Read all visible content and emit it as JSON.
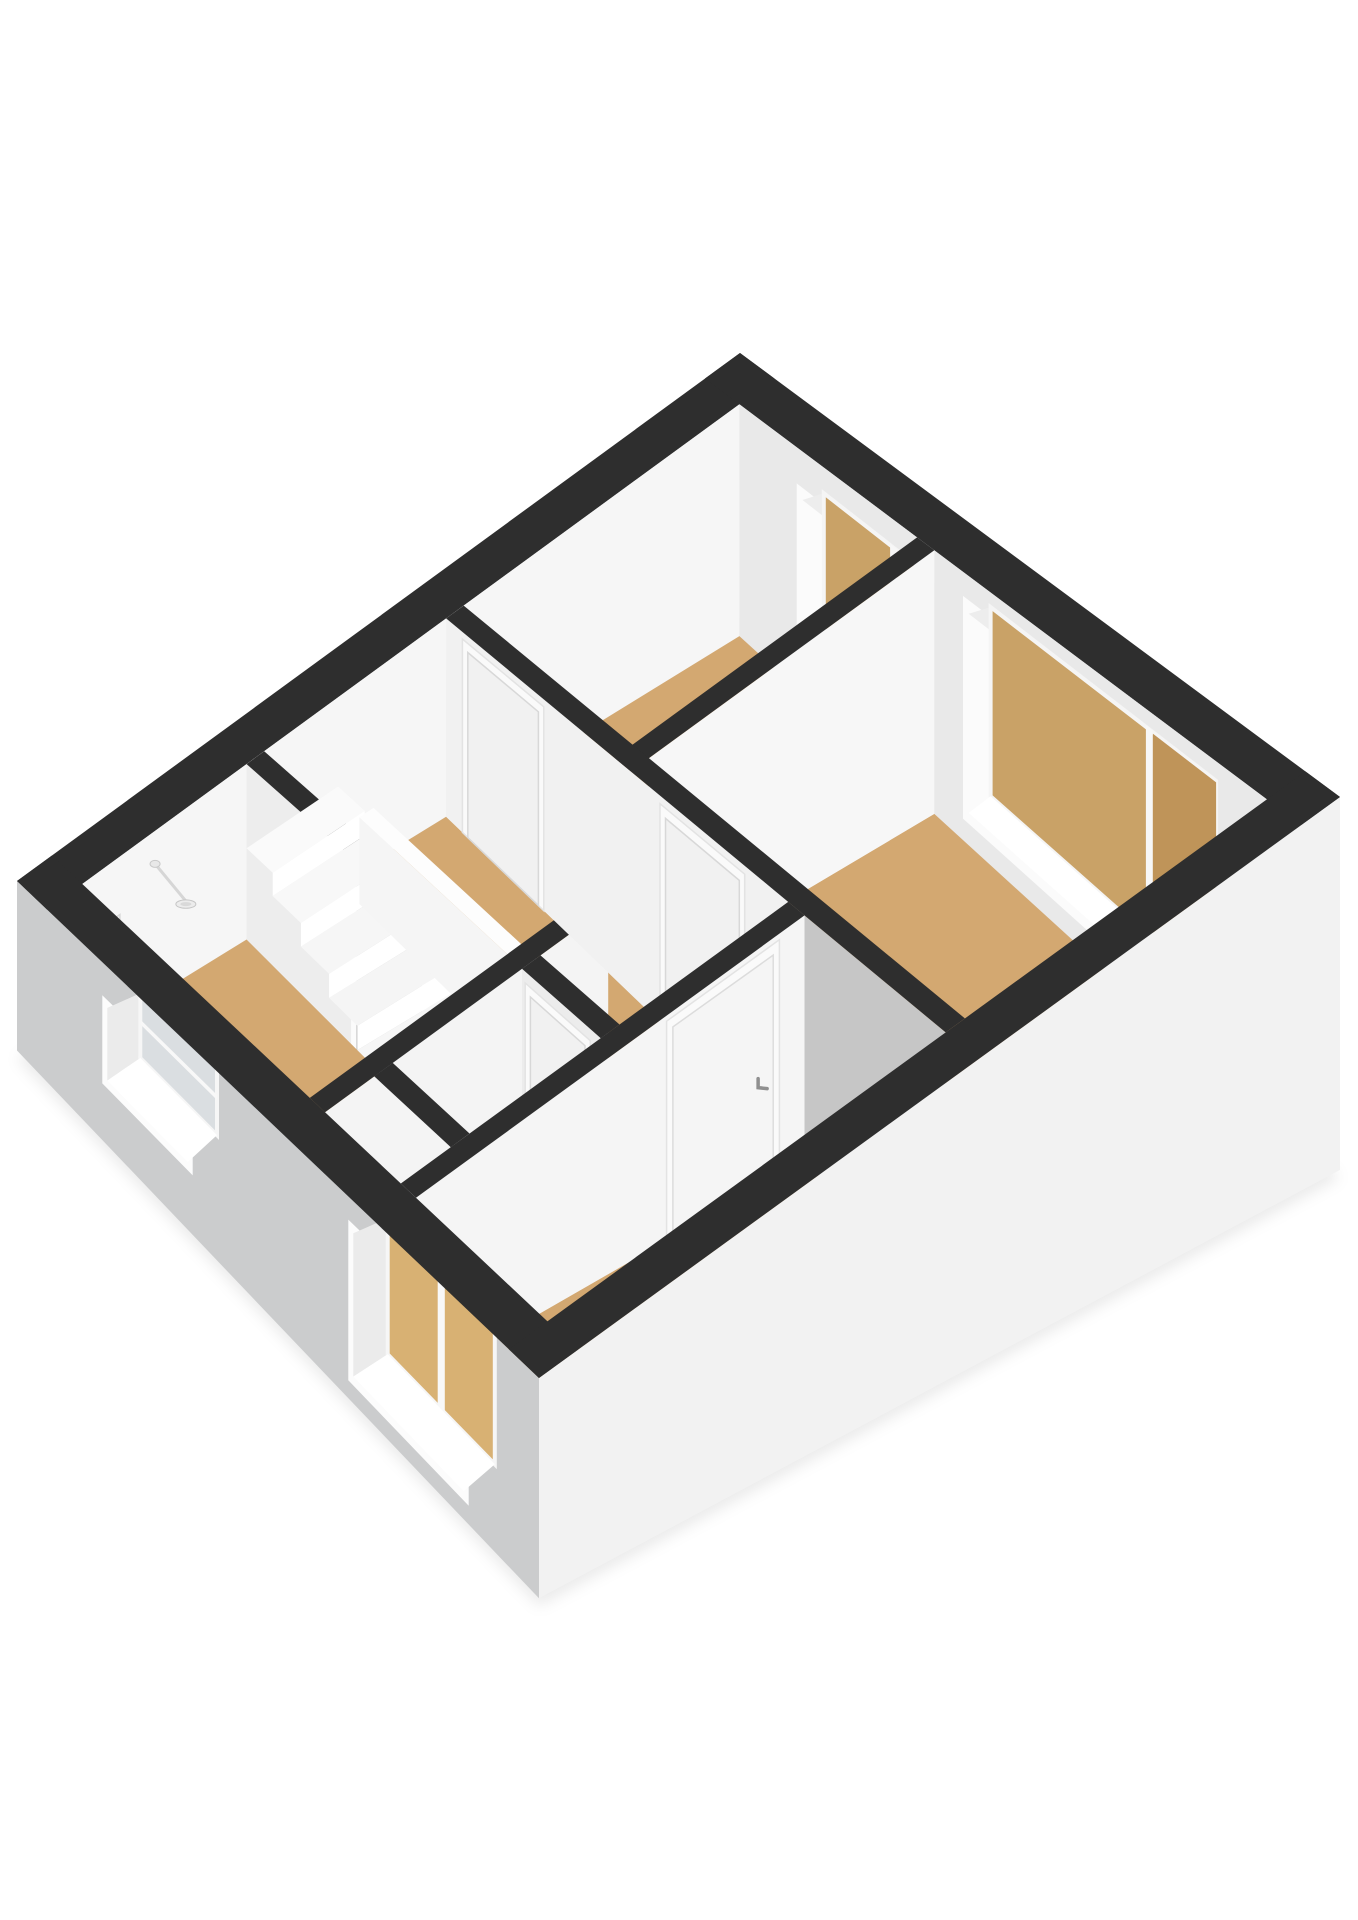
{
  "scene": {
    "width": 1358,
    "height": 1920,
    "background": "#ffffff"
  },
  "projection": {
    "A": 6.2,
    "B": 5.2,
    "W": [
      17,
      881
    ],
    "N": [
      740,
      353
    ],
    "S": [
      539,
      1378
    ],
    "E": [
      1340,
      797
    ],
    "heights": {
      "W": 150,
      "N": 230,
      "S": 195,
      "E": 330
    },
    "facadeDepth": 0.13
  },
  "palette": {
    "background": "#ffffff",
    "wall_top": "#2e2e2e",
    "wall_interior_bright": "#f6f6f6",
    "wall_interior_light": "#ededed",
    "wall_interior_shaded": "#c6c6c6",
    "facade_sw": "#cbcccd",
    "facade_se": "#f2f2f2",
    "floor_wood": "#d3a871",
    "floor_closet": "#c3c3c3",
    "shower_tray": "#b9c3cd",
    "window_pane_tan": "#c9a267",
    "window_pane_tan_dark": "#bf9459",
    "window_pane_frosted": "#dadee1",
    "door_frame": "#fafafa",
    "door_leaf": "#f1f1f1",
    "stair_white": "#fafafa"
  },
  "elements": [
    {
      "name": "ground-shadow",
      "kind": "shadow",
      "pts": [
        [
          0,
          0,
          -0.13
        ],
        [
          6.2,
          0,
          -0.13
        ],
        [
          6.2,
          5.2,
          -0.13
        ],
        [
          0,
          5.2,
          -0.13
        ]
      ],
      "dy": 8,
      "fill": "rgba(0,0,0,0.08)"
    },
    {
      "name": "wall-top-nw",
      "kind": "rectZ",
      "u0": 0,
      "v0": 0,
      "u1": 6.2,
      "v1": 0.3,
      "z": 1,
      "fill": "#2e2e2e"
    },
    {
      "name": "wall-nw-interior-face",
      "kind": "faceV",
      "b": 0.3,
      "u0": 0.3,
      "u1": 5.9,
      "z0": 0,
      "z1": 1,
      "fill": "#f6f6f6"
    },
    {
      "name": "shower-set",
      "kind": "shower",
      "wallV": 0.3,
      "u": 0.92,
      "rosetteZ": 0.8,
      "ctrlU": 0.55,
      "ctrlZ0": 0.47,
      "ctrlZ1": 0.64,
      "ctrlW": 0.14
    },
    {
      "name": "wall-top-ne",
      "kind": "rectZ",
      "u0": 5.9,
      "v0": 0,
      "u1": 6.2,
      "v1": 5.2,
      "z": 1,
      "fill": "#2e2e2e"
    },
    {
      "name": "wall-ne-interior-face",
      "kind": "faceU",
      "a": 5.9,
      "v0": 0.3,
      "v1": 4.9,
      "z0": 0,
      "z1": 1,
      "fill": "#e9e9e9"
    },
    {
      "name": "window-bedroom-north",
      "kind": "windowNE",
      "v0": 0.85,
      "v1": 1.8,
      "z0": 0.16,
      "z1": 0.8,
      "mull": 0.66,
      "pane": "#c9a267",
      "pane2": "#bf9459"
    },
    {
      "name": "window-bedroom-east",
      "kind": "windowNE",
      "v0": 2.3,
      "v1": 4.3,
      "z0": 0.12,
      "z1": 0.86,
      "mull": 0.7,
      "pane": "#c9a267",
      "pane2": "#bf9459"
    },
    {
      "name": "floor-bedroom-north",
      "kind": "rectZ",
      "u0": 3.55,
      "v0": 0.3,
      "u1": 5.9,
      "v1": 1.85,
      "z": 0,
      "fill": "#d3a871"
    },
    {
      "name": "floor-bedroom-east",
      "kind": "rectZ",
      "u0": 3.55,
      "v0": 2.0,
      "u1": 5.9,
      "v1": 4.9,
      "z": 0,
      "fill": "#d3a871"
    },
    {
      "name": "floor-patch-east-corner",
      "kind": "rectZ",
      "u0": 3.55,
      "v0": 4.45,
      "u1": 4.4,
      "v1": 4.9,
      "z": 0,
      "fill": "#f2f2f2"
    },
    {
      "name": "floor-bathroom",
      "kind": "rectZ",
      "u0": 0.3,
      "v0": 0.3,
      "u1": 1.7,
      "v1": 2.55,
      "z": 0,
      "fill": "#d3a871"
    },
    {
      "name": "shower-tray",
      "kind": "rectZ",
      "u0": 0.4,
      "v0": 0.92,
      "u1": 1.08,
      "v1": 2.4,
      "z": 0.01,
      "fill": "#b9c3cd",
      "stroke": "#e9edf0"
    },
    {
      "name": "floor-landing-main",
      "kind": "rectZ",
      "u0": 2.6,
      "v0": 0.3,
      "u1": 3.4,
      "v1": 3.45,
      "z": 0,
      "fill": "#d3a871"
    },
    {
      "name": "floor-landing-top",
      "kind": "rectZ",
      "u0": 1.7,
      "v0": 0.3,
      "u1": 2.6,
      "v1": 0.55,
      "z": 0,
      "fill": "#d3a871"
    },
    {
      "name": "floor-landing-side",
      "kind": "rectZ",
      "u0": 2.05,
      "v0": 2.7,
      "u1": 2.6,
      "v1": 3.45,
      "z": 0,
      "fill": "#d3a871"
    },
    {
      "name": "floor-closet",
      "kind": "rectZ",
      "u0": 0.85,
      "v0": 2.7,
      "u1": 1.9,
      "v1": 3.45,
      "z": 0,
      "fill": "#c3c3c3"
    },
    {
      "name": "floor-bedroom-south",
      "kind": "rectZ",
      "u0": 0.3,
      "v0": 3.6,
      "u1": 3.4,
      "v1": 4.9,
      "z": 0,
      "fill": "#d3a871"
    },
    {
      "name": "wall-bedrooms-divider-face",
      "kind": "faceV",
      "b": 2.0,
      "u0": 3.55,
      "u1": 5.9,
      "z0": 0,
      "z1": 1,
      "fill": "#f7f7f7"
    },
    {
      "name": "wall-bedrooms-divider-top",
      "kind": "rectZ",
      "u0": 3.4,
      "v0": 1.85,
      "u1": 5.9,
      "v1": 2.0,
      "z": 1,
      "fill": "#2e2e2e"
    },
    {
      "name": "wall-bathroom-east-face",
      "kind": "faceU",
      "a": 1.7,
      "v0": 0.3,
      "v1": 2.55,
      "z0": 0,
      "z1": 1,
      "fill": "#ededed"
    },
    {
      "name": "door-bathroom-open",
      "kind": "doorOpen",
      "a": 1.7,
      "v0": 1.35,
      "v1": 1.98,
      "z1": 0.92,
      "void": "#c2c2c2",
      "jamb": "#fbfbfb"
    },
    {
      "name": "wall-bathroom-east-top",
      "kind": "rectZ",
      "u0": 1.7,
      "v0": 0.3,
      "u1": 1.85,
      "v1": 2.55,
      "z": 1,
      "fill": "#2e2e2e"
    },
    {
      "name": "stair-upper-box-top",
      "kind": "rectZ",
      "u0": 1.7,
      "v0": 0.3,
      "u1": 2.48,
      "v1": 0.55,
      "z": 0.52,
      "fill": "#fafafa"
    },
    {
      "name": "stair-upper-box-riser",
      "kind": "faceV",
      "b": 0.55,
      "u0": 1.7,
      "u1": 2.48,
      "z0": 0.39,
      "z1": 0.52,
      "fill": "#ffffff"
    },
    {
      "name": "stair-tread-1",
      "kind": "rectZ",
      "u0": 1.7,
      "v0": 0.55,
      "u1": 2.48,
      "v1": 0.82,
      "z": 0.39,
      "fill": "#f8f8f8"
    },
    {
      "name": "stair-riser-1",
      "kind": "faceV",
      "b": 0.82,
      "u0": 1.7,
      "u1": 2.48,
      "z0": 0.26,
      "z1": 0.39,
      "fill": "#ffffff"
    },
    {
      "name": "stair-tread-2",
      "kind": "rectZ",
      "u0": 1.7,
      "v0": 0.82,
      "u1": 2.48,
      "v1": 1.09,
      "z": 0.26,
      "fill": "#f6f6f6"
    },
    {
      "name": "stair-riser-2",
      "kind": "faceV",
      "b": 1.09,
      "u0": 1.7,
      "u1": 2.48,
      "z0": 0.13,
      "z1": 0.26,
      "fill": "#ffffff"
    },
    {
      "name": "stair-tread-3",
      "kind": "rectZ",
      "u0": 1.7,
      "v0": 1.09,
      "u1": 2.48,
      "v1": 1.36,
      "z": 0.13,
      "fill": "#f5f5f5"
    },
    {
      "name": "stair-riser-3",
      "kind": "faceV",
      "b": 1.36,
      "u0": 1.7,
      "u1": 2.48,
      "z0": 0,
      "z1": 0.13,
      "fill": "#ffffff"
    },
    {
      "name": "stair-tread-4",
      "kind": "rectZ",
      "u0": 1.7,
      "v0": 1.36,
      "u1": 2.48,
      "v1": 1.63,
      "z": 0,
      "fill": "#f6f6f6"
    },
    {
      "name": "stair-riser-4",
      "kind": "faceV",
      "b": 1.63,
      "u0": 1.7,
      "u1": 2.48,
      "z0": -0.13,
      "z1": 0,
      "fill": "#fdfdfd"
    },
    {
      "name": "stairwell-opening",
      "kind": "poly",
      "pts": [
        [
          1.7,
          1.9,
          0
        ],
        [
          2.1,
          1.63,
          0
        ],
        [
          2.48,
          1.63,
          0
        ],
        [
          2.48,
          2.55,
          0
        ],
        [
          1.7,
          2.55,
          0
        ]
      ],
      "fill": "#ffffff"
    },
    {
      "name": "stair-tread-5",
      "kind": "rectZ",
      "u0": 2.1,
      "v0": 1.63,
      "u1": 2.48,
      "v1": 1.9,
      "z": -0.13,
      "fill": "#f2f2f2"
    },
    {
      "name": "stair-riser-5",
      "kind": "faceV",
      "b": 1.9,
      "u0": 1.7,
      "u1": 2.48,
      "z0": -0.26,
      "z1": -0.13,
      "fill": "#fafafa"
    },
    {
      "name": "stair-tread-6",
      "kind": "rectZ",
      "u0": 1.7,
      "v0": 1.9,
      "u1": 2.48,
      "v1": 2.3,
      "z": -0.26,
      "fill": "#eeeeee"
    },
    {
      "name": "stair-stringer-sawtooth",
      "kind": "sawtooth",
      "a": 2.48,
      "v0": 1.42,
      "v1": 2.52,
      "zs": 0.05,
      "ze": -0.36,
      "band": 0.11,
      "teeth": 8,
      "depth": 0.075,
      "fill": "#fdfdfd"
    },
    {
      "name": "stair-balustrade-face",
      "kind": "faceU",
      "a": 2.48,
      "v0": 0.5,
      "v1": 2.28,
      "z0": 0,
      "z1": 0.46,
      "fill": "#f5f5f5"
    },
    {
      "name": "stair-balustrade-end",
      "kind": "faceV",
      "b": 2.28,
      "u0": 2.48,
      "u1": 2.6,
      "z0": 0,
      "z1": 0.46,
      "fill": "#eeeeee"
    },
    {
      "name": "stair-balustrade-top",
      "kind": "rectZ",
      "u0": 2.48,
      "v0": 0.5,
      "u1": 2.6,
      "v1": 2.28,
      "z": 0.46,
      "fill": "#fdfdfd"
    },
    {
      "name": "wall-bathroom-south-face",
      "kind": "faceV",
      "b": 2.7,
      "u0": 0.3,
      "u1": 2.6,
      "z0": 0,
      "z1": 1,
      "fill": "#f4f4f4"
    },
    {
      "name": "wall-bathroom-south-top",
      "kind": "rectZ",
      "u0": 0.3,
      "v0": 2.55,
      "u1": 2.6,
      "v1": 2.7,
      "z": 1,
      "fill": "#2e2e2e"
    },
    {
      "name": "wall-closet-west-top",
      "kind": "rectZ",
      "u0": 0.7,
      "v0": 2.7,
      "u1": 0.85,
      "v1": 3.45,
      "z": 1,
      "fill": "#2e2e2e"
    },
    {
      "name": "wall-closet-east-face",
      "kind": "faceU",
      "a": 1.9,
      "v0": 2.7,
      "v1": 3.45,
      "z0": 0,
      "z1": 1,
      "fill": "#ececec"
    },
    {
      "name": "door-closet",
      "kind": "doorU",
      "a": 1.9,
      "v0": 2.78,
      "v1": 3.3,
      "z1": 0.9
    },
    {
      "name": "wall-closet-east-top",
      "kind": "rectZ",
      "u0": 1.9,
      "v0": 2.7,
      "u1": 2.05,
      "v1": 3.45,
      "z": 1,
      "fill": "#2e2e2e"
    },
    {
      "name": "wall-rooms-west-face-hall",
      "kind": "faceU",
      "a": 3.4,
      "v0": 0.3,
      "v1": 3.45,
      "z0": 0,
      "z1": 1,
      "fill": "#f1f1f1"
    },
    {
      "name": "wall-rooms-west-face-south",
      "kind": "faceU",
      "a": 3.4,
      "v0": 3.45,
      "v1": 4.9,
      "z0": 0,
      "z1": 1,
      "fill": "#c6c6c6"
    },
    {
      "name": "door-bedroom-north",
      "kind": "doorU",
      "a": 3.4,
      "v0": 0.5,
      "v1": 1.15,
      "z1": 0.92
    },
    {
      "name": "door-bedroom-east",
      "kind": "doorU",
      "a": 3.4,
      "v0": 2.32,
      "v1": 3.0,
      "z1": 0.92
    },
    {
      "name": "wall-rooms-west-top",
      "kind": "rectZ",
      "u0": 3.4,
      "v0": 0.3,
      "u1": 3.55,
      "v1": 4.9,
      "z": 1,
      "fill": "#2e2e2e"
    },
    {
      "name": "wall-bedroom-south-north-face",
      "kind": "faceV",
      "b": 3.6,
      "u0": 0.3,
      "u1": 3.4,
      "z0": 0,
      "z1": 1,
      "fill": "#f5f5f5"
    },
    {
      "name": "door-bedroom-south",
      "kind": "doorV",
      "b": 3.6,
      "u0": 2.35,
      "u1": 3.15,
      "z1": 0.93,
      "handle": true
    },
    {
      "name": "wall-bedroom-south-north-top",
      "kind": "rectZ",
      "u0": 0.3,
      "v0": 3.45,
      "u1": 3.4,
      "v1": 3.6,
      "z": 1,
      "fill": "#2e2e2e"
    },
    {
      "name": "facade-sw",
      "kind": "faceU",
      "a": 0,
      "v0": 0,
      "v1": 5.2,
      "z0": -0.13,
      "z1": 1,
      "fill": "#cbcccd"
    },
    {
      "name": "window-bathroom",
      "kind": "windowSW",
      "v0": 0.9,
      "v1": 1.7,
      "z0": 0.28,
      "z1": 0.74,
      "pane": "#dadee1",
      "transom": 0.55
    },
    {
      "name": "window-bedroom-south",
      "kind": "windowSW",
      "v0": 3.35,
      "v1": 4.45,
      "z0": 0.02,
      "z1": 0.82,
      "pane": "#d8b173",
      "mull": 0.5
    },
    {
      "name": "facade-sw-top",
      "kind": "rectZ",
      "u0": 0,
      "v0": 0,
      "u1": 0.3,
      "v1": 5.2,
      "z": 1,
      "fill": "#2e2e2e"
    },
    {
      "name": "facade-se",
      "kind": "faceV",
      "b": 5.2,
      "u0": 0,
      "u1": 6.2,
      "z0": -0.13,
      "z1": 1,
      "fill": "#f2f2f2"
    },
    {
      "name": "facade-se-top",
      "kind": "rectZ",
      "u0": 0,
      "v0": 4.9,
      "u1": 6.2,
      "v1": 5.2,
      "z": 1,
      "fill": "#2e2e2e"
    }
  ]
}
